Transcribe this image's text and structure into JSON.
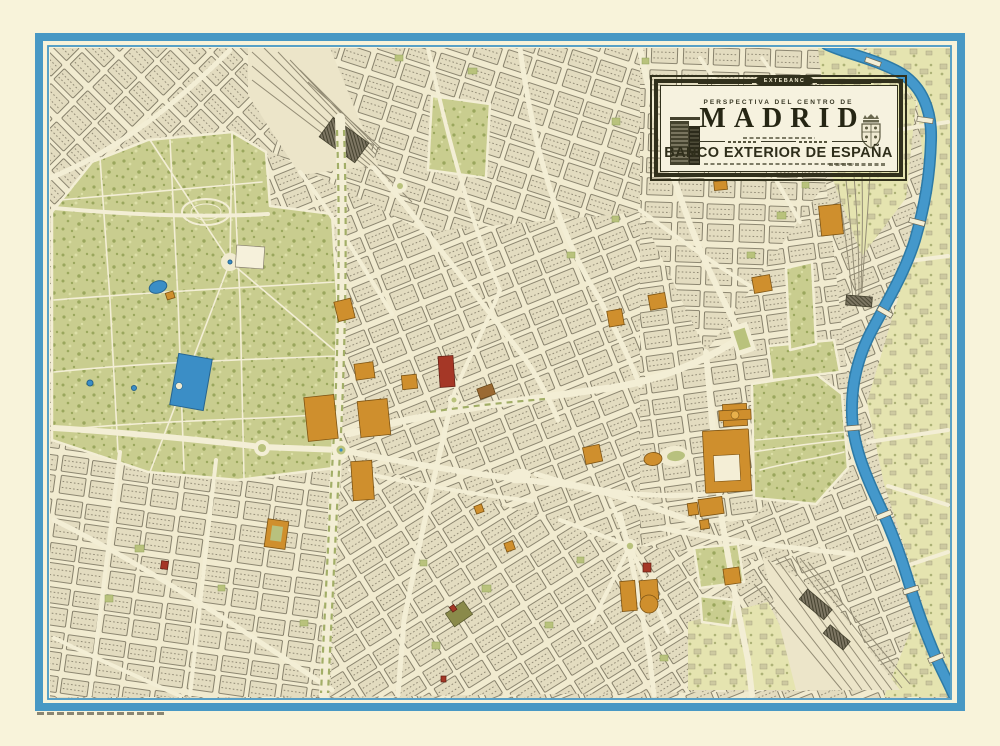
{
  "poster": {
    "kind": "pictorial-city-map"
  },
  "cartouche": {
    "tab_label": "EXTEBANC",
    "kicker": "PERSPECTIVA DEL CENTRO DE",
    "title": "MADRID",
    "bank_name": "BANCO EXTERIOR DE ESPAÑA"
  },
  "colors": {
    "paper": "#f8f3da",
    "map_bg": "#f1ebd0",
    "street": "#f3eed5",
    "border_blue": "#4898c4",
    "river": "#4498cb",
    "river_edge": "#2d7aa6",
    "park": "#c9cd8f",
    "park_light": "#e5e4b0",
    "block_fill": "#e3dcc0",
    "block_line": "#6e6854",
    "hatch": "#8e8772",
    "landmark_orange": "#cf8f2d",
    "landmark_orange_dark": "#7d5414",
    "landmark_red": "#a53726",
    "frame_dark": "#31301c",
    "cartouche_bg": "#f6f2df",
    "median_green": "#a2ae67",
    "plaza_green": "#b9c27c",
    "rail": "#948d76",
    "water_fill": "#3b8ec6",
    "water_edge": "#27648f"
  },
  "features": [
    "retiro-park",
    "retiro-grand-pond",
    "crystal-palace-pond",
    "royal-palace",
    "almudena-cathedral",
    "campo-del-moro-gardens",
    "sabatini-gardens",
    "plaza-de-oriente",
    "manzanares-river",
    "atocha-rail-fan",
    "north-railyard",
    "south-railyard",
    "cibeles-plaza",
    "gran-via",
    "paseo-boulevard",
    "plaza-de-espana",
    "bridges",
    "title-cartouche"
  ]
}
